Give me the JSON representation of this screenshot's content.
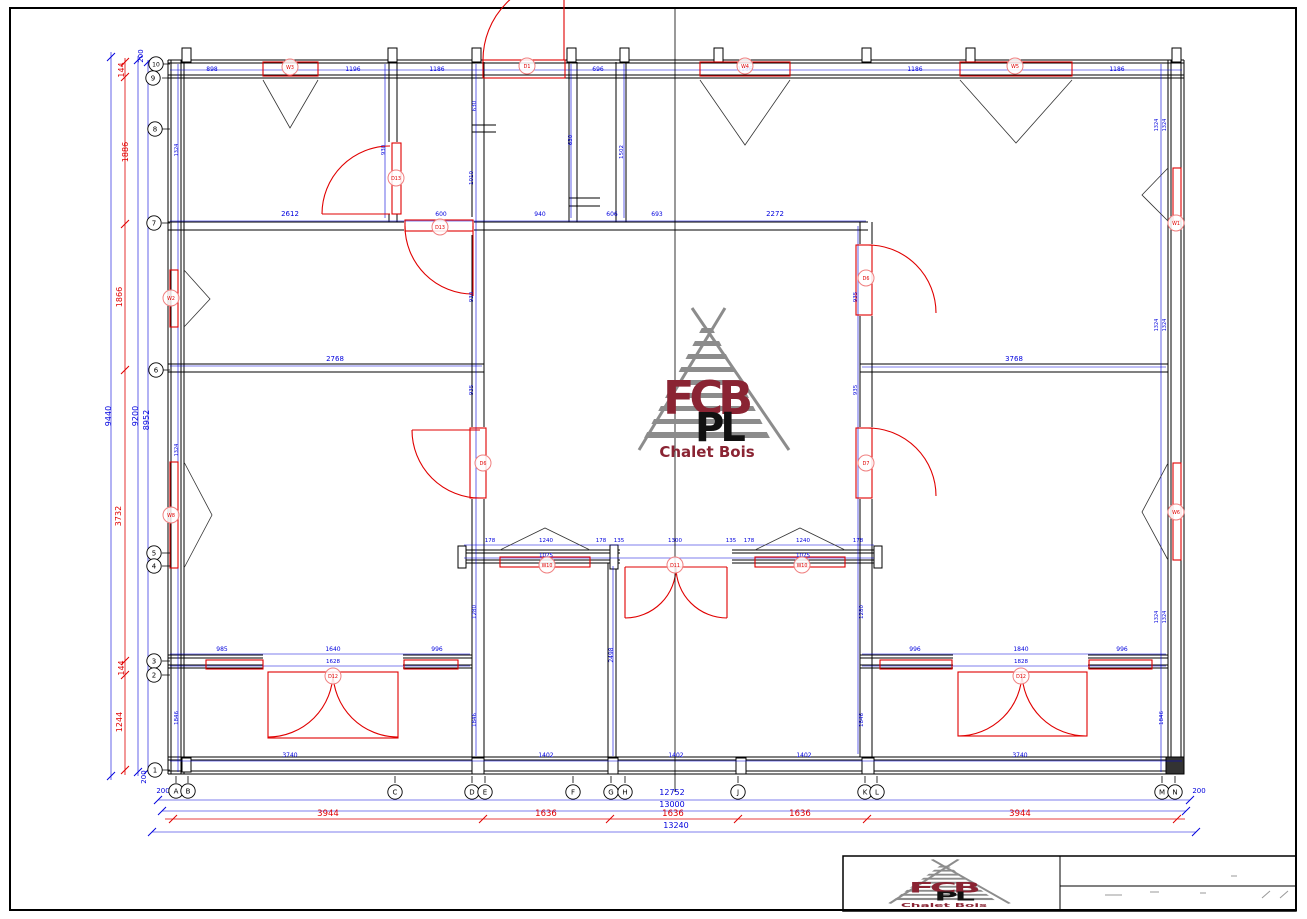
{
  "colors": {
    "wall": "#000000",
    "dim_blue": "#0000dd",
    "dim_red": "#e00000",
    "balloon_ring": "#f08080",
    "logo_gray": "#8c8c8c",
    "logo_maroon": "#8a2433"
  },
  "logo": {
    "fcb": "FCB",
    "pl": "PL",
    "caption": "Chalet Bois"
  },
  "grid_bubbles": {
    "left": [
      [
        "10",
        156,
        64
      ],
      [
        "9",
        153,
        78
      ],
      [
        "8",
        155,
        129
      ],
      [
        "7",
        154,
        223
      ],
      [
        "6",
        156,
        370
      ],
      [
        "5",
        154,
        553
      ],
      [
        "4",
        154,
        566
      ],
      [
        "3",
        154,
        661
      ],
      [
        "2",
        154,
        675
      ],
      [
        "1",
        155,
        770
      ]
    ],
    "bottom": [
      [
        "A",
        176,
        791
      ],
      [
        "B",
        188,
        791
      ],
      [
        "C",
        395,
        792
      ],
      [
        "D",
        472,
        792
      ],
      [
        "E",
        485,
        792
      ],
      [
        "F",
        573,
        792
      ],
      [
        "G",
        611,
        792
      ],
      [
        "H",
        625,
        792
      ],
      [
        "J",
        738,
        792
      ],
      [
        "K",
        865,
        792
      ],
      [
        "L",
        877,
        792
      ],
      [
        "M",
        1162,
        792
      ],
      [
        "N",
        1175,
        792
      ]
    ]
  },
  "balloons": [
    [
      "W3",
      290,
      67
    ],
    [
      "D1",
      527,
      66
    ],
    [
      "W4",
      745,
      66
    ],
    [
      "W5",
      1015,
      66
    ],
    [
      "D13",
      396,
      178
    ],
    [
      "D13",
      440,
      227
    ],
    [
      "W2",
      171,
      298
    ],
    [
      "W8",
      171,
      515
    ],
    [
      "W1",
      1176,
      223
    ],
    [
      "W6",
      1176,
      512
    ],
    [
      "D6",
      483,
      463
    ],
    [
      "D6",
      866,
      278
    ],
    [
      "D7",
      866,
      463
    ],
    [
      "W10",
      547,
      565
    ],
    [
      "D11",
      675,
      565
    ],
    [
      "W10",
      802,
      565
    ],
    [
      "D12",
      333,
      676
    ],
    [
      "D12",
      1021,
      676
    ]
  ],
  "blue_labels": [
    [
      212,
      71,
      "898",
      6,
      0
    ],
    [
      353,
      71,
      "1196",
      6,
      0
    ],
    [
      437,
      71,
      "1186",
      6,
      0
    ],
    [
      598,
      71,
      "696",
      6,
      0
    ],
    [
      745,
      71,
      "1186",
      6,
      0
    ],
    [
      915,
      71,
      "1186",
      6,
      0
    ],
    [
      1117,
      71,
      "1186",
      6,
      0
    ],
    [
      290,
      216,
      "2612",
      7,
      0
    ],
    [
      441,
      216,
      "600",
      6,
      0
    ],
    [
      540,
      216,
      "940",
      6,
      0
    ],
    [
      612,
      216,
      "606",
      6,
      0
    ],
    [
      657,
      216,
      "693",
      6,
      0
    ],
    [
      775,
      216,
      "2272",
      7,
      0
    ],
    [
      335,
      361,
      "2768",
      7,
      0
    ],
    [
      1014,
      361,
      "3768",
      7,
      0
    ],
    [
      490,
      542,
      "178",
      5.5,
      0
    ],
    [
      546,
      542,
      "1240",
      5.5,
      0
    ],
    [
      601,
      542,
      "178",
      5.5,
      0
    ],
    [
      619,
      542,
      "135",
      5.5,
      0
    ],
    [
      675,
      542,
      "1300",
      5.5,
      0
    ],
    [
      731,
      542,
      "135",
      5.5,
      0
    ],
    [
      749,
      542,
      "178",
      5.5,
      0
    ],
    [
      803,
      542,
      "1240",
      5.5,
      0
    ],
    [
      858,
      542,
      "178",
      5.5,
      0
    ],
    [
      546,
      557,
      "1025",
      5.5,
      0
    ],
    [
      803,
      557,
      "1025",
      5.5,
      0
    ],
    [
      222,
      651,
      "985",
      6,
      0
    ],
    [
      333,
      651,
      "1640",
      6,
      0
    ],
    [
      437,
      651,
      "996",
      6,
      0
    ],
    [
      333,
      663,
      "1628",
      5.5,
      0
    ],
    [
      915,
      651,
      "996",
      6,
      0
    ],
    [
      1021,
      651,
      "1840",
      6,
      0
    ],
    [
      1122,
      651,
      "996",
      6,
      0
    ],
    [
      1021,
      663,
      "1828",
      5.5,
      0
    ],
    [
      290,
      757,
      "3740",
      6,
      0
    ],
    [
      546,
      757,
      "1402",
      6,
      0
    ],
    [
      676,
      757,
      "1402",
      6,
      0
    ],
    [
      804,
      757,
      "1402",
      6,
      0
    ],
    [
      1020,
      757,
      "3740",
      6,
      0
    ],
    [
      672,
      795,
      "12752",
      8,
      0
    ],
    [
      672,
      807,
      "13000",
      8,
      0
    ],
    [
      676,
      828,
      "13240",
      8,
      0
    ],
    [
      163,
      793,
      "200",
      7,
      0
    ],
    [
      1199,
      793,
      "200",
      7,
      0
    ],
    [
      111,
      416,
      "9440",
      8,
      1
    ],
    [
      138,
      416,
      "9200",
      8,
      1
    ],
    [
      149,
      420,
      "8952",
      8,
      1
    ],
    [
      143,
      56,
      "200",
      7,
      1
    ],
    [
      146,
      777,
      "200",
      7,
      1
    ],
    [
      385,
      150,
      "930",
      5.5,
      1
    ],
    [
      476,
      106,
      "630",
      5.5,
      1
    ],
    [
      473,
      178,
      "1010",
      5.5,
      1
    ],
    [
      473,
      297,
      "930",
      5.5,
      1
    ],
    [
      473,
      390,
      "935",
      5.5,
      1
    ],
    [
      572,
      140,
      "630",
      5.5,
      1
    ],
    [
      623,
      152,
      "1502",
      5.5,
      1
    ],
    [
      857,
      297,
      "935",
      5.5,
      1
    ],
    [
      857,
      390,
      "935",
      5.5,
      1
    ],
    [
      613,
      655,
      "2498",
      6,
      1
    ],
    [
      476,
      612,
      "1280",
      5.5,
      1
    ],
    [
      863,
      612,
      "1280",
      5.5,
      1
    ],
    [
      178,
      718,
      "1846",
      5.5,
      1
    ],
    [
      476,
      720,
      "1846",
      5.5,
      1
    ],
    [
      863,
      720,
      "1846",
      5.5,
      1
    ],
    [
      1163,
      718,
      "1846",
      5.5,
      1
    ],
    [
      1158,
      125,
      "1324",
      5,
      1
    ],
    [
      1166,
      125,
      "1324",
      5,
      1
    ],
    [
      1158,
      325,
      "1324",
      5,
      1
    ],
    [
      1166,
      325,
      "1324",
      5,
      1
    ],
    [
      1158,
      617,
      "1324",
      5,
      1
    ],
    [
      1166,
      617,
      "1324",
      5,
      1
    ],
    [
      178,
      150,
      "1324",
      5,
      1
    ],
    [
      178,
      450,
      "1324",
      5,
      1
    ]
  ],
  "red_labels": [
    [
      124,
      70,
      "144",
      8,
      1
    ],
    [
      128,
      152,
      "1886",
      8,
      1
    ],
    [
      122,
      297,
      "1866",
      8,
      1
    ],
    [
      121,
      516,
      "3732",
      8,
      1
    ],
    [
      124,
      668,
      "144",
      8,
      1
    ],
    [
      122,
      722,
      "1244",
      8,
      1
    ],
    [
      328,
      816,
      "3944",
      8.5,
      0
    ],
    [
      546,
      816,
      "1636",
      8.5,
      0
    ],
    [
      673,
      816,
      "1636",
      8.5,
      0
    ],
    [
      800,
      816,
      "1636",
      8.5,
      0
    ],
    [
      1020,
      816,
      "3944",
      8.5,
      0
    ]
  ],
  "ticks": {
    "red": [
      [
        173,
        819
      ],
      [
        483,
        819
      ],
      [
        610,
        819
      ],
      [
        738,
        819
      ],
      [
        867,
        819
      ],
      [
        1177,
        819
      ],
      [
        125,
        62
      ],
      [
        125,
        77
      ],
      [
        125,
        224
      ],
      [
        125,
        370
      ],
      [
        125,
        661
      ],
      [
        125,
        675
      ],
      [
        125,
        770
      ]
    ],
    "blue": [
      [
        158,
        800
      ],
      [
        1190,
        800
      ],
      [
        162,
        811
      ],
      [
        1186,
        811
      ],
      [
        152,
        832
      ],
      [
        1196,
        832
      ],
      [
        111,
        57
      ],
      [
        111,
        776
      ],
      [
        138,
        60
      ],
      [
        138,
        772
      ],
      [
        148,
        62
      ],
      [
        148,
        770
      ]
    ]
  }
}
